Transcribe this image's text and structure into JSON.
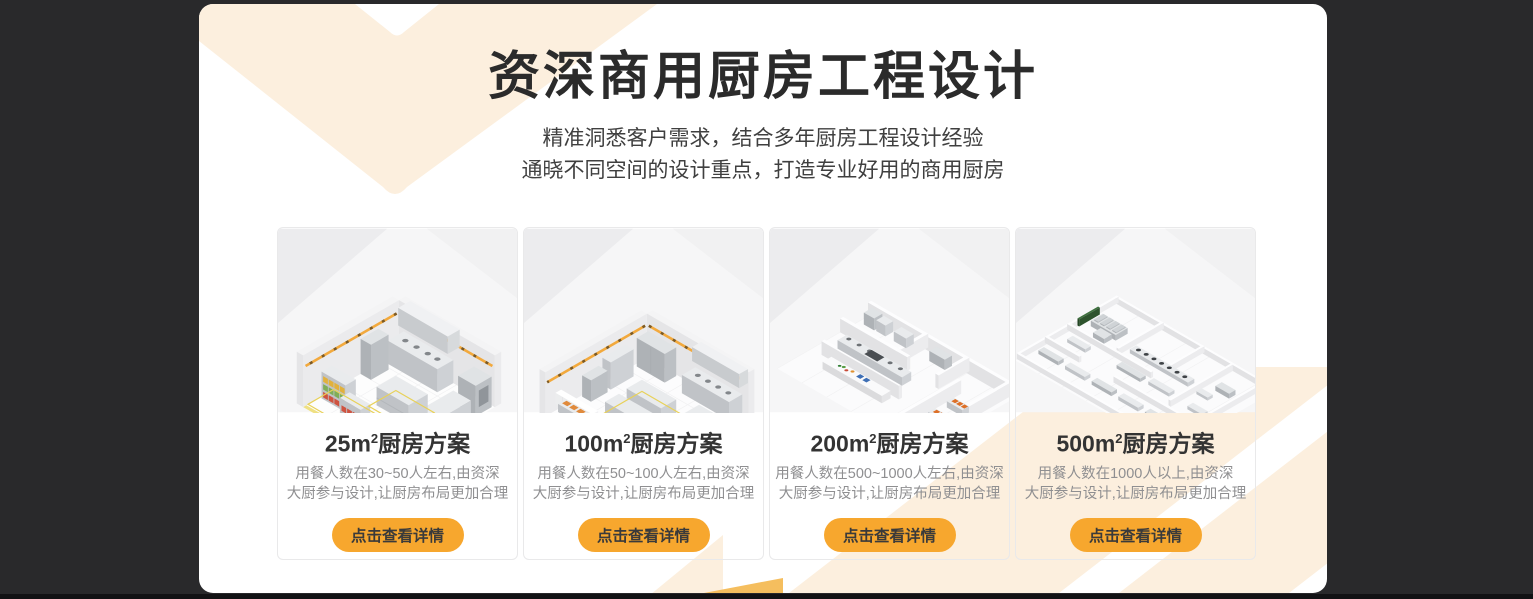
{
  "theme": {
    "accent": "#F7A72E",
    "cream": "#FCEFDE",
    "gold": "#F5BE5E",
    "page_background": "#29292B",
    "panel_background": "#FFFFFF",
    "title_color": "#2B2B2B",
    "description_color": "#8F8F91"
  },
  "header": {
    "title": "资深商用厨房工程设计",
    "subtitle_line1": "精准洞悉客户需求，结合多年厨房工程设计经验",
    "subtitle_line2": "通晓不同空间的设计重点，打造专业好用的商用厨房"
  },
  "cards": [
    {
      "area_label": "25m",
      "area_sup": "2",
      "title_suffix": "厨房方案",
      "desc_line1": "用餐人数在30~50人左右,由资深",
      "desc_line2": "大厨参与设计,让厨房布局更加合理",
      "button_label": "点击查看详情",
      "image_alt": "isometric-kitchen-render-25"
    },
    {
      "area_label": "100m",
      "area_sup": "2",
      "title_suffix": "厨房方案",
      "desc_line1": "用餐人数在50~100人左右,由资深",
      "desc_line2": "大厨参与设计,让厨房布局更加合理",
      "button_label": "点击查看详情",
      "image_alt": "isometric-kitchen-render-100"
    },
    {
      "area_label": "200m",
      "area_sup": "2",
      "title_suffix": "厨房方案",
      "desc_line1": "用餐人数在500~1000人左右,由资深",
      "desc_line2": "大厨参与设计,让厨房布局更加合理",
      "button_label": "点击查看详情",
      "image_alt": "isometric-kitchen-render-200"
    },
    {
      "area_label": "500m",
      "area_sup": "2",
      "title_suffix": "厨房方案",
      "desc_line1": "用餐人数在1000人以上,由资深",
      "desc_line2": "大厨参与设计,让厨房布局更加合理",
      "button_label": "点击查看详情",
      "image_alt": "isometric-kitchen-render-500"
    }
  ]
}
